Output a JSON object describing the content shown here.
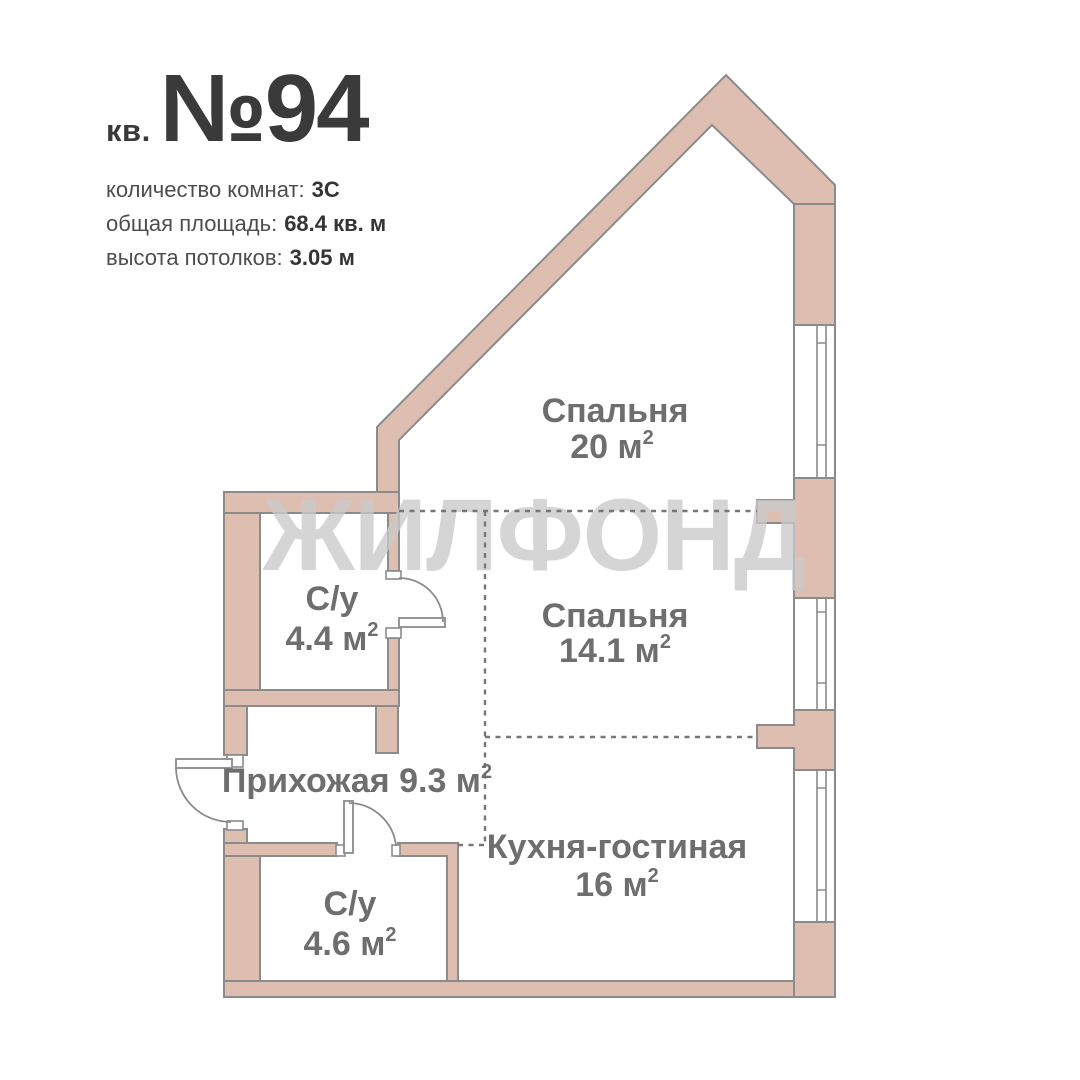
{
  "header": {
    "apt_prefix": "кв.",
    "apt_number": "№94",
    "details": [
      {
        "label": "количество комнат:",
        "value": "3С"
      },
      {
        "label": "общая площадь:",
        "value": "68.4 кв. м"
      },
      {
        "label": "высота потолков:",
        "value": "3.05 м"
      }
    ]
  },
  "watermark": "ЖИЛФОНД",
  "rooms": [
    {
      "name": "Спальня",
      "area": "20 м",
      "sup": "2"
    },
    {
      "name": "Спальня",
      "area": "14.1 м",
      "sup": "2"
    },
    {
      "name": "Кухня-гостиная",
      "area": "16 м",
      "sup": "2"
    },
    {
      "name": "С/у",
      "area": "4.4 м",
      "sup": "2"
    },
    {
      "name": "С/у",
      "area": "4.6 м",
      "sup": "2"
    },
    {
      "name": "Прихожая 9.3 м",
      "sup": "2"
    }
  ],
  "colors": {
    "wall_fill": "#DFBEB2",
    "wall_outline": "#8B8B8B",
    "dashed_divider": "#767676",
    "room_label": "#6E6E6E",
    "title_text": "#3A3A3A",
    "watermark": "#C9C9C9",
    "background": "#FFFFFF"
  }
}
